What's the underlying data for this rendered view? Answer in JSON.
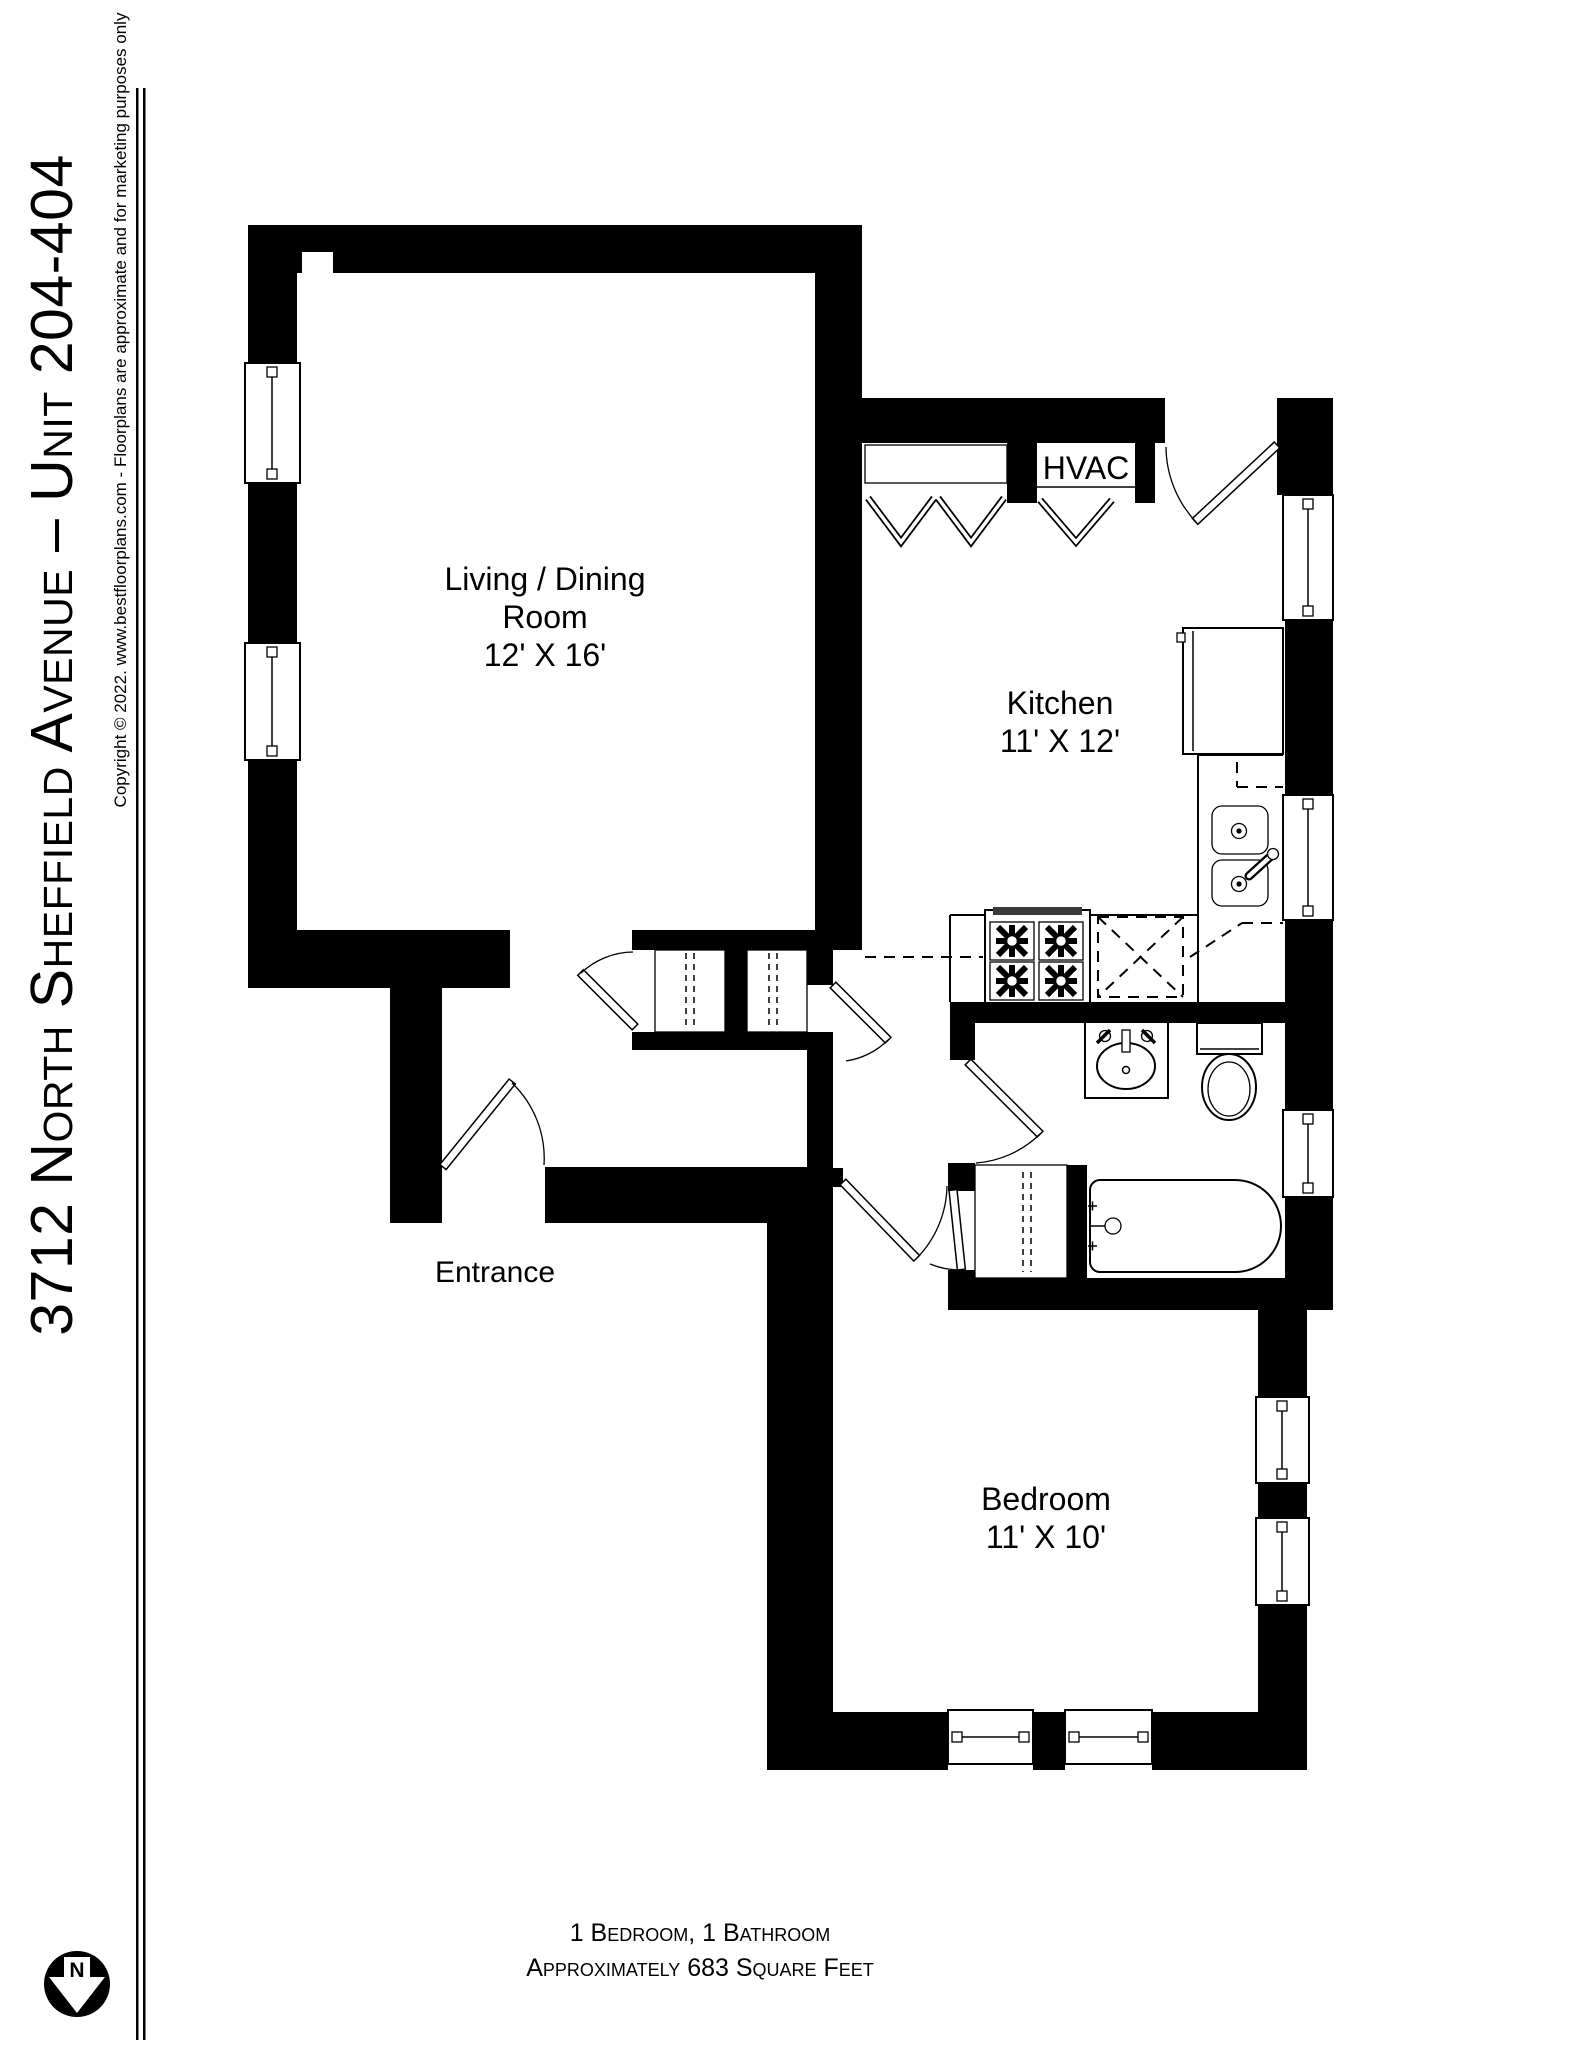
{
  "colors": {
    "ink": "#000000",
    "paper": "#ffffff"
  },
  "sidebar": {
    "title": "3712 North Sheffield Avenue – Unit 204-404",
    "copyright": "Copyright © 2022. www.bestfloorplans.com - Floorplans are approximate and for marketing purposes only"
  },
  "rooms": {
    "living": {
      "name": "Living / Dining",
      "name2": "Room",
      "dims": "12' X 16'"
    },
    "kitchen": {
      "name": "Kitchen",
      "dims": "11' X 12'"
    },
    "hvac": {
      "label": "HVAC"
    },
    "entrance": {
      "label": "Entrance"
    },
    "bedroom": {
      "name": "Bedroom",
      "dims": "11' X 10'"
    }
  },
  "footer": {
    "line1": "1 Bedroom, 1 Bathroom",
    "line2": "Approximately 683 Square Feet"
  },
  "compass": {
    "label": "N"
  }
}
